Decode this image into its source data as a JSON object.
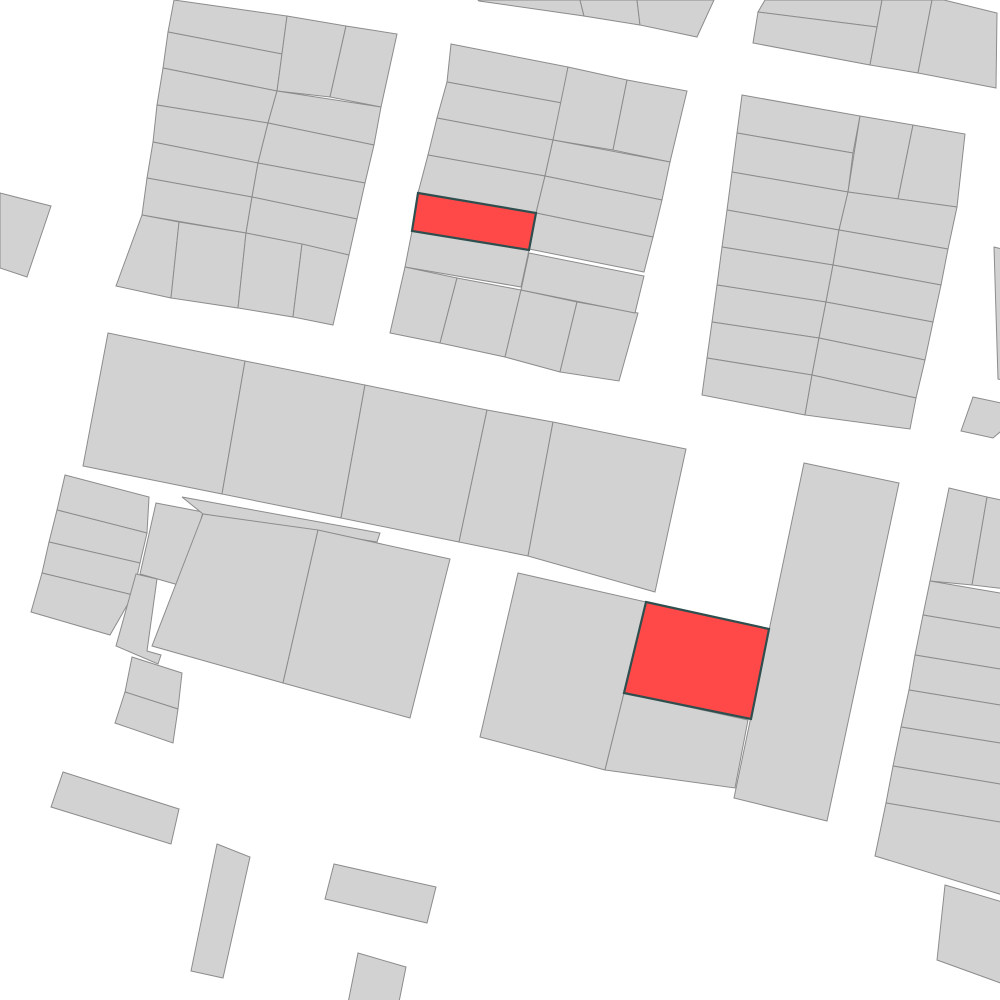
{
  "map": {
    "canvas": {
      "width": 1000,
      "height": 1000,
      "background": "#ffffff"
    },
    "style": {
      "parcel_fill": "#d2d2d2",
      "parcel_stroke": "#8c8c8c",
      "parcel_stroke_width": 1,
      "highlight_fill": "#ff4949",
      "highlight_stroke": "#2f4f4f",
      "highlight_stroke_width": 2.2
    },
    "highlight_count": 2,
    "parcels": [
      {
        "pts": "174,0 287,16 282,54 168,32",
        "hl": false
      },
      {
        "pts": "168,32 282,54 277,91 163,68",
        "hl": false
      },
      {
        "pts": "163,68 277,91 268,123 157,105",
        "hl": false
      },
      {
        "pts": "157,105 268,123 258,163 153,142",
        "hl": false
      },
      {
        "pts": "153,142 258,163 252,197 147,178",
        "hl": false
      },
      {
        "pts": "147,178 252,197 246,233 142,215",
        "hl": false
      },
      {
        "pts": "287,16 346,26 330,97 277,91",
        "hl": false
      },
      {
        "pts": "346,26 397,34 381,107 330,97",
        "hl": false
      },
      {
        "pts": "277,91 381,107 374,145 268,123",
        "hl": false
      },
      {
        "pts": "268,123 374,145 365,183 258,163",
        "hl": false
      },
      {
        "pts": "258,163 365,183 357,219 252,197",
        "hl": false
      },
      {
        "pts": "252,197 357,219 349,255 246,233",
        "hl": false
      },
      {
        "pts": "142,215 179,222 171,298 116,286",
        "hl": false
      },
      {
        "pts": "179,222 246,233 238,308 171,298",
        "hl": false
      },
      {
        "pts": "246,233 302,244 293,317 238,308",
        "hl": false
      },
      {
        "pts": "302,244 349,255 333,325 293,317",
        "hl": false
      },
      {
        "pts": "478,0 580,0 584,16 479,1",
        "hl": false
      },
      {
        "pts": "580,0 637,0 640,25 584,16",
        "hl": false
      },
      {
        "pts": "637,0 714,0 697,37 640,25",
        "hl": false
      },
      {
        "pts": "451,44 568,67 562,103 447,82",
        "hl": false
      },
      {
        "pts": "447,82 562,103 553,140 437,118",
        "hl": false
      },
      {
        "pts": "437,118 553,140 545,176 428,155",
        "hl": false
      },
      {
        "pts": "428,155 545,176 536,213 418,193",
        "hl": false
      },
      {
        "pts": "418,193 536,213 529,250 412,231",
        "hl": true
      },
      {
        "pts": "412,231 529,250 521,287 405,267",
        "hl": false
      },
      {
        "pts": "405,267 457,278 440,343 390,333",
        "hl": false
      },
      {
        "pts": "457,278 521,290 505,357 440,343",
        "hl": false
      },
      {
        "pts": "521,290 577,302 560,372 505,357",
        "hl": false
      },
      {
        "pts": "577,302 638,313 619,381 560,372",
        "hl": false
      },
      {
        "pts": "568,67 627,80 613,150 553,140",
        "hl": false
      },
      {
        "pts": "627,80 687,91 670,162 613,150",
        "hl": false
      },
      {
        "pts": "553,140 670,162 662,200 545,176",
        "hl": false
      },
      {
        "pts": "545,176 662,200 653,237 536,213",
        "hl": false
      },
      {
        "pts": "536,213 653,237 644,272 529,249",
        "hl": false
      },
      {
        "pts": "529,253 644,276 635,313 521,290",
        "hl": false
      },
      {
        "pts": "765,0 882,0 877,27 758,12",
        "hl": false
      },
      {
        "pts": "758,12 877,27 870,65 753,43",
        "hl": false
      },
      {
        "pts": "882,0 932,0 918,73 870,65",
        "hl": false
      },
      {
        "pts": "932,0 944,0 997,13 996,88 918,73",
        "hl": false
      },
      {
        "pts": "742,95 860,116 853,153 737,133",
        "hl": false
      },
      {
        "pts": "737,133 853,153 848,192 732,172",
        "hl": false
      },
      {
        "pts": "732,172 848,192 839,230 727,210",
        "hl": false
      },
      {
        "pts": "727,210 839,230 833,265 722,247",
        "hl": false
      },
      {
        "pts": "722,247 833,265 826,302 717,285",
        "hl": false
      },
      {
        "pts": "717,285 826,302 819,338 712,322",
        "hl": false
      },
      {
        "pts": "712,322 819,338 812,375 707,358",
        "hl": false
      },
      {
        "pts": "707,358 812,375 805,415 702,395",
        "hl": false
      },
      {
        "pts": "860,116 913,125 898,199 848,192",
        "hl": false
      },
      {
        "pts": "913,125 965,134 957,207 898,199",
        "hl": false
      },
      {
        "pts": "848,192 957,207 948,249 839,230",
        "hl": false
      },
      {
        "pts": "839,230 948,249 941,285 833,265",
        "hl": false
      },
      {
        "pts": "833,265 941,285 933,322 826,302",
        "hl": false
      },
      {
        "pts": "826,302 933,322 925,360 819,338",
        "hl": false
      },
      {
        "pts": "819,338 925,360 916,398 812,375",
        "hl": false
      },
      {
        "pts": "812,375 916,398 910,429 805,415",
        "hl": false
      },
      {
        "pts": "994,247 1006,250 1006,381 998,379",
        "hl": false
      },
      {
        "pts": "973,397 1006,404 1006,427 993,438 961,431",
        "hl": false
      },
      {
        "pts": "0,193 51,206 27,277 0,268",
        "hl": false
      },
      {
        "pts": "108,333 245,361 222,494 83,466",
        "hl": false
      },
      {
        "pts": "245,361 365,385 341,518 222,494",
        "hl": false
      },
      {
        "pts": "365,385 487,410 459,542 341,518",
        "hl": false
      },
      {
        "pts": "487,410 553,422 528,556 459,542",
        "hl": false
      },
      {
        "pts": "553,422 686,449 655,592 528,556",
        "hl": false
      },
      {
        "pts": "65,475 149,497 147,533 57,510",
        "hl": false
      },
      {
        "pts": "57,510 147,533 140,563 49,542",
        "hl": false
      },
      {
        "pts": "49,542 140,563 133,595 42,573",
        "hl": false
      },
      {
        "pts": "42,573 133,595 110,635 31,612",
        "hl": false
      },
      {
        "pts": "156,503 203,512 182,586 140,574",
        "hl": false
      },
      {
        "pts": "136,574 157,579 147,651 161,655 158,664 116,646",
        "hl": false
      },
      {
        "pts": "182,497 380,533 377,542 203,514",
        "hl": false
      },
      {
        "pts": "203,514 318,530 283,683 152,646",
        "hl": false
      },
      {
        "pts": "318,530 450,559 410,718 283,683",
        "hl": false
      },
      {
        "pts": "132,657 182,673 178,709 125,692",
        "hl": false
      },
      {
        "pts": "125,692 178,709 173,743 115,723",
        "hl": false
      },
      {
        "pts": "518,573 646,602 624,693 605,770 480,737",
        "hl": false
      },
      {
        "pts": "646,602 769,629 751,719 624,693",
        "hl": true
      },
      {
        "pts": "624,693 748,720 735,788 605,770",
        "hl": false
      },
      {
        "pts": "804,463 899,483 827,821 734,798",
        "hl": false
      },
      {
        "pts": "949,488 987,497 972,585 930,581",
        "hl": false
      },
      {
        "pts": "987,497 1006,501 1006,589 972,585",
        "hl": false
      },
      {
        "pts": "930,581 1006,594 1006,629 923,615",
        "hl": false
      },
      {
        "pts": "923,615 1006,629 1006,670 915,655",
        "hl": false
      },
      {
        "pts": "915,655 1006,670 1006,706 909,690",
        "hl": false
      },
      {
        "pts": "909,690 1006,706 1006,744 901,727",
        "hl": false
      },
      {
        "pts": "901,727 1006,744 1006,785 893,766",
        "hl": false
      },
      {
        "pts": "893,766 1006,785 1006,823 886,803",
        "hl": false
      },
      {
        "pts": "886,803 1006,823 1006,896 875,856",
        "hl": false
      },
      {
        "pts": "945,885 1006,903 1006,985 937,960",
        "hl": false
      },
      {
        "pts": "63,772 179,809 171,844 51,807",
        "hl": false
      },
      {
        "pts": "217,844 250,857 223,978 191,971",
        "hl": false
      },
      {
        "pts": "334,864 436,887 427,923 325,899",
        "hl": false
      },
      {
        "pts": "358,953 406,967 396,1017 348,1003",
        "hl": false
      }
    ]
  }
}
